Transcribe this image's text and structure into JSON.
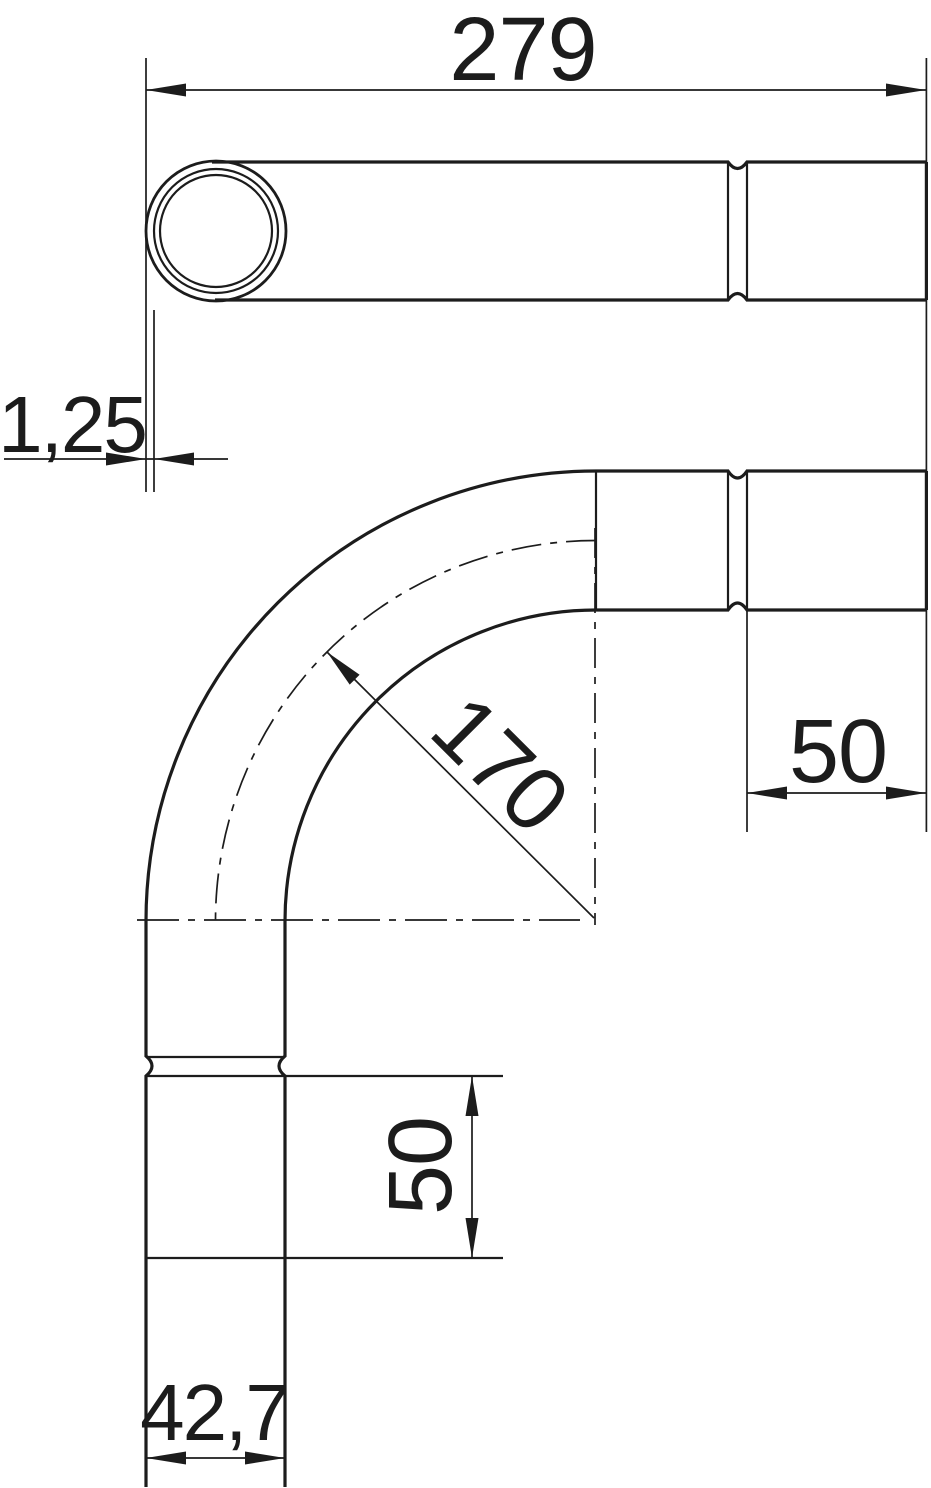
{
  "page": {
    "background_color": "#ffffff",
    "line_color": "#1c1c1c",
    "description": "Technical dimension drawing of a 90-degree conduit pipe bend with push-in sockets, shown in two projections"
  },
  "drawing": {
    "labels": {
      "overall_length": "279",
      "wall_thickness": "1,25",
      "bend_radius": "170",
      "socket_length_right": "50",
      "socket_length_bottom": "50",
      "outer_diameter": "42,7"
    }
  }
}
